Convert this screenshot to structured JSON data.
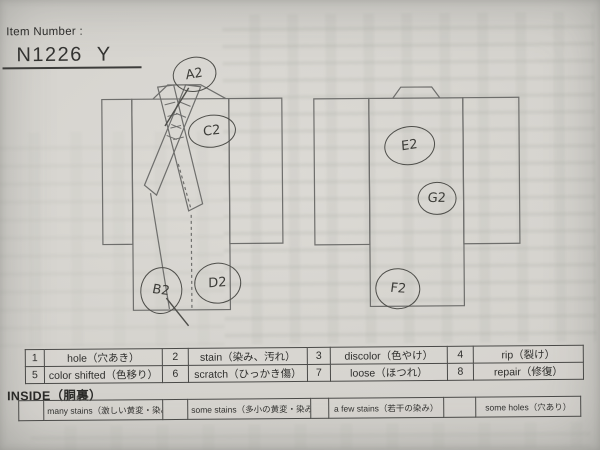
{
  "colors": {
    "paper": "#d4d2cd",
    "ink": "#333331",
    "sketch_line": "#6e6e6c",
    "table_border": "#4a4a48"
  },
  "header": {
    "item_number_label": "Item Number :",
    "item_number": "N1226",
    "item_code": "Y"
  },
  "annotations": [
    {
      "id": "A2",
      "label": "A2",
      "area": "front-collar"
    },
    {
      "id": "B2",
      "label": "B2",
      "area": "front-hem-left"
    },
    {
      "id": "C2",
      "label": "C2",
      "area": "front-chest-right"
    },
    {
      "id": "D2",
      "label": "D2",
      "area": "front-hem-center"
    },
    {
      "id": "E2",
      "label": "E2",
      "area": "back-upper"
    },
    {
      "id": "F2",
      "label": "F2",
      "area": "back-hem-left"
    },
    {
      "id": "G2",
      "label": "G2",
      "area": "back-middle-right"
    }
  ],
  "legend_table": {
    "cells": [
      {
        "num": "1",
        "label": "hole（穴あき）"
      },
      {
        "num": "2",
        "label": "stain（染み、汚れ）"
      },
      {
        "num": "3",
        "label": "discolor（色やけ）"
      },
      {
        "num": "4",
        "label": "rip（裂け）"
      },
      {
        "num": "5",
        "label": "color shifted（色移り）"
      },
      {
        "num": "6",
        "label": "scratch（ひっかき傷）"
      },
      {
        "num": "7",
        "label": "loose（ほつれ）"
      },
      {
        "num": "8",
        "label": "repair（修復）"
      }
    ]
  },
  "inside_section": {
    "title": "INSIDE（胴裏）",
    "options": [
      {
        "label": "many stains（激しい黄変・染み）"
      },
      {
        "label": "some stains（多小の黄変・染み）"
      },
      {
        "label": "a few stains（若干の染み）"
      },
      {
        "label": "some holes（穴あり）"
      }
    ]
  }
}
